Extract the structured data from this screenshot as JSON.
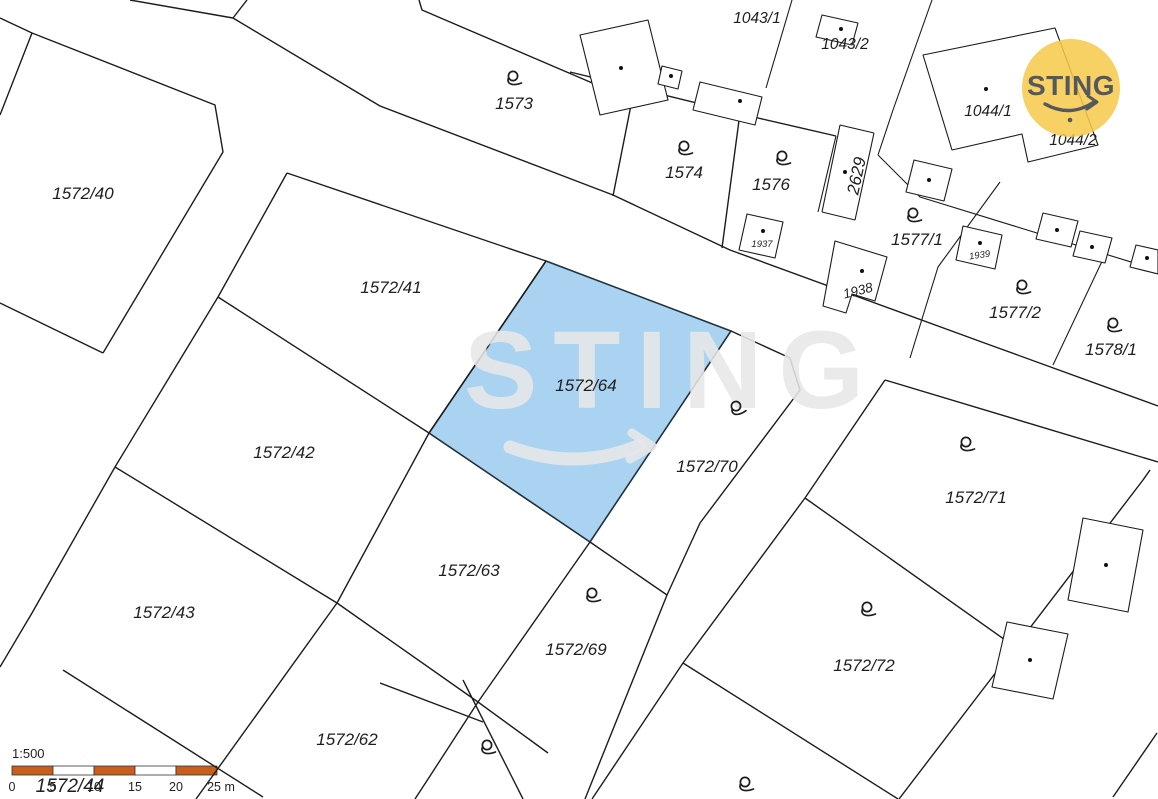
{
  "map": {
    "type": "cadastral-map",
    "scale": "1:500",
    "selected_parcel": "1572/64",
    "selected_fill": "#a9d3f0",
    "line_color": "#1c1c1c",
    "background": "#ffffff",
    "labels": {
      "p1572_40": "1572/40",
      "p1572_41": "1572/41",
      "p1572_42": "1572/42",
      "p1572_43": "1572/43",
      "p1572_44": "1572/44",
      "p1572_62": "1572/62",
      "p1572_63": "1572/63",
      "p1572_64": "1572/64",
      "p1572_69": "1572/69",
      "p1572_70": "1572/70",
      "p1572_71": "1572/71",
      "p1572_72": "1572/72",
      "p1573": "1573",
      "p1574": "1574",
      "p1576": "1576",
      "p2629": "2629",
      "p1937": "1937",
      "p1938": "1938",
      "p1939": "1939",
      "p1043_1": "1043/1",
      "p1043_2": "1043/2",
      "p1044_1": "1044/1",
      "p1044_2": "1044/2",
      "p1577_1": "1577/1",
      "p1577_2": "1577/2",
      "p1578_1": "1578/1"
    }
  },
  "watermark": {
    "text": "STING"
  },
  "logo": {
    "text": "STING",
    "circle_color": "#f7c94b",
    "text_color": "#55585c"
  },
  "scalebar": {
    "ratio": "1:500",
    "bar_color": "#c75e1e",
    "unit_ticks": [
      "0",
      "5",
      "10",
      "15",
      "20",
      "25 m"
    ]
  }
}
